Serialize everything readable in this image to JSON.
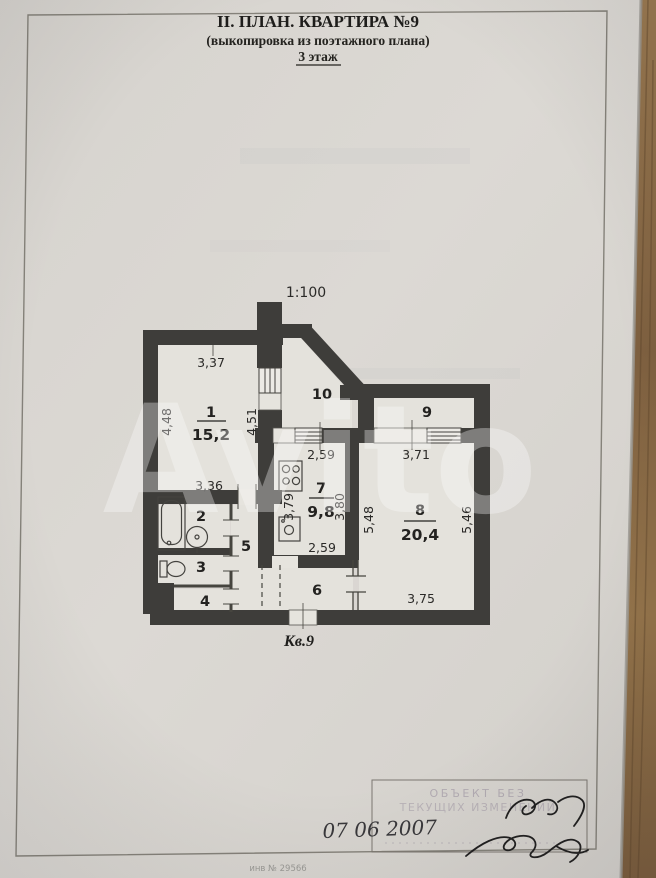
{
  "document": {
    "title_line1": "II. ПЛАН. КВАРТИРА №9",
    "title_line2": "(выкопировка из поэтажного плана)",
    "title_line3": "3 этаж",
    "scale": "1:100",
    "apartment_label": "Кв.9",
    "inventory_number": "инв № 29566"
  },
  "stamp": {
    "line1": "ОБЪЕКТ БЕЗ",
    "line2": "ТЕКУЩИХ ИЗМЕНЕНИЙ",
    "date": "07 06  2007"
  },
  "watermark": "Avito",
  "rooms": {
    "r1": {
      "number": "1",
      "area": "15,2"
    },
    "r2": {
      "number": "2"
    },
    "r3": {
      "number": "3"
    },
    "r4": {
      "number": "4"
    },
    "r5": {
      "number": "5"
    },
    "r6": {
      "number": "6"
    },
    "r7": {
      "number": "7",
      "area": "9,8"
    },
    "r8": {
      "number": "8",
      "area": "20,4"
    },
    "r9": {
      "number": "9"
    },
    "r10": {
      "number": "10"
    }
  },
  "dimensions": {
    "room1_top": "3,37",
    "room1_left": "4,48",
    "room1_right": "4,51",
    "bath_top": "3,36",
    "kitchen_top": "2,59",
    "kitchen_left": "3,79",
    "kitchen_right": "3,80",
    "kitchen_bottom": "2,59",
    "room8_top": "3,71",
    "room8_left": "5,48",
    "room8_right": "5,46",
    "room8_bottom": "3,75"
  },
  "colors": {
    "paper": "#dad7d2",
    "wall": "#3e3d3a",
    "wood_table": "#8d6e47",
    "ink": "#262523"
  }
}
